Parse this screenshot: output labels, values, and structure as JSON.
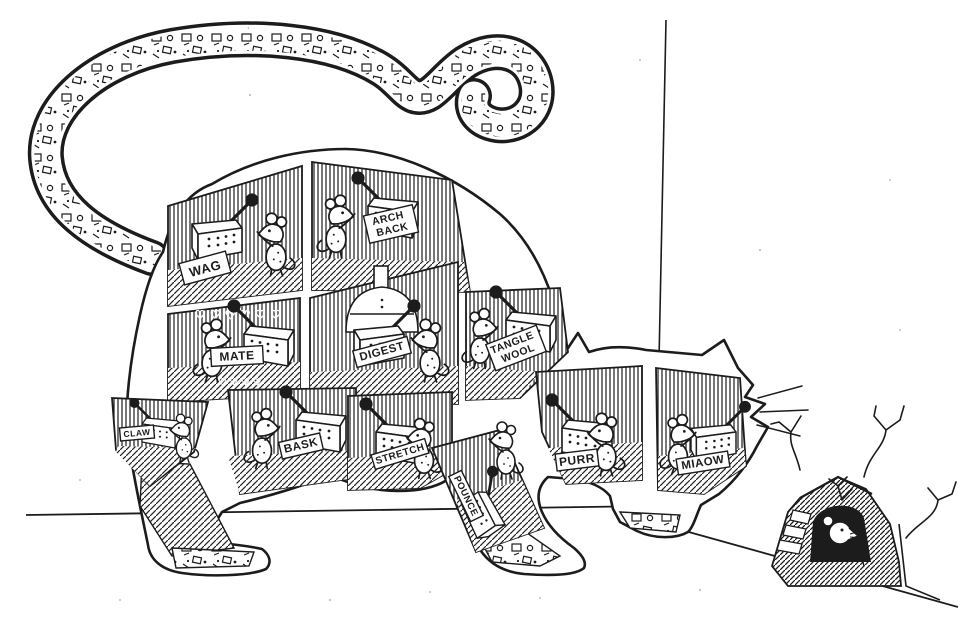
{
  "illustration": {
    "kind": "ink-cartoon",
    "ink_color": "#1c1c1c",
    "paper_color": "#ffffff"
  },
  "compartments": [
    {
      "id": "wag",
      "label": "WAG",
      "lines": [
        "WAG"
      ]
    },
    {
      "id": "arch-back",
      "label": "ARCH BACK",
      "lines": [
        "ARCH",
        "BACK"
      ]
    },
    {
      "id": "mate",
      "label": "MATE",
      "lines": [
        "MATE"
      ],
      "decor_top": "♡ ♡ ♡ ♡ ♡ ♡",
      "decor_bottom": "♡ ♡ ♡ ♡"
    },
    {
      "id": "digest",
      "label": "DIGEST",
      "lines": [
        "DIGEST"
      ]
    },
    {
      "id": "tangle-wool",
      "label": "TANGLE WOOL",
      "lines": [
        "TANGLE",
        "WOOL"
      ]
    },
    {
      "id": "claw",
      "label": "CLAW",
      "lines": [
        "CLAW"
      ]
    },
    {
      "id": "bask",
      "label": "BASK",
      "lines": [
        "BASK"
      ]
    },
    {
      "id": "stretch",
      "label": "STRETCH",
      "lines": [
        "STRETCH"
      ]
    },
    {
      "id": "pounce",
      "label": "POUNCE",
      "lines": [
        "POUNCE"
      ]
    },
    {
      "id": "purr",
      "label": "PURR",
      "lines": [
        "PURR"
      ]
    },
    {
      "id": "miaow",
      "label": "MIAOW",
      "lines": [
        "MIAOW"
      ]
    }
  ]
}
